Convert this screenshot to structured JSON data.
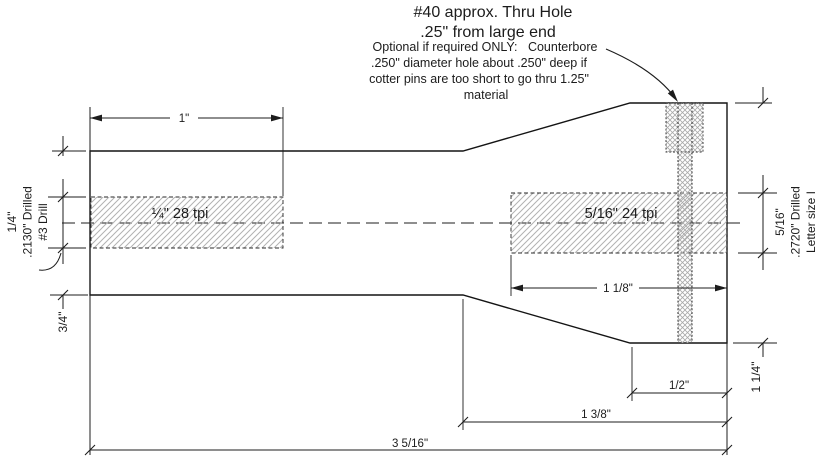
{
  "drawing": {
    "notes": {
      "title_line1": "#40 approx. Thru Hole",
      "title_line2": ".25\" from large end",
      "body_line1": "Optional if required ONLY:   Counterbore",
      "body_line2": ".250\" diameter hole about .250\" deep if",
      "body_line3": "cotter pins are too short to go thru 1.25\"",
      "body_line4": "material"
    },
    "threads": {
      "small_end": "¼\" 28 tpi",
      "large_end": "5/16\" 24 tpi"
    },
    "left_hole": {
      "diameter": "1/4\"",
      "drill_size": ".2130\" Drilled",
      "drill": "#3 Drill"
    },
    "right_hole": {
      "diameter": "5/16\"",
      "drill_size": ".2720\" Drilled",
      "drill": "Letter size I"
    },
    "dims": {
      "small_thread_length": "1\"",
      "large_thread_length": "1 1/8\"",
      "small_end_diameter": "3/4\"",
      "large_end_diameter": "1 1/4\"",
      "large_flat_length": "1/2\"",
      "large_section_length": "1 3/8\"",
      "overall_length": "3 5/16\""
    },
    "colors": {
      "line": "#1c1c1c",
      "hatch": "#b2b2b2",
      "crosshatch": "#a9a9a9",
      "background": "#ffffff"
    }
  }
}
